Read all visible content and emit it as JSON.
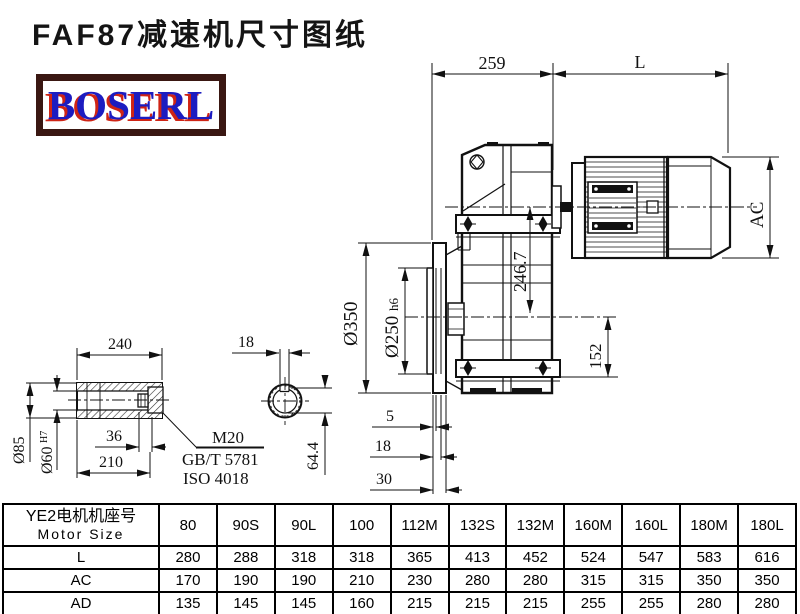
{
  "page": {
    "title": "FAF87减速机尺寸图纸",
    "logo": "BOSERL"
  },
  "drawing": {
    "dim_259": "259",
    "dim_L": "L",
    "dim_AC": "AC",
    "dim_246_7": "246.7",
    "dim_152": "152",
    "dim_d350": "Ø350",
    "dim_d250": "Ø250",
    "dim_d250_tol": "h6",
    "dim_5": "5",
    "dim_18_flange": "18",
    "dim_30": "30",
    "dim_240": "240",
    "dim_36": "36",
    "dim_210": "210",
    "dim_d85": "Ø85",
    "dim_d60": "Ø60",
    "dim_d60_tol": "H7",
    "dim_18_key": "18",
    "dim_64_4": "64.4",
    "note_thread": "M20",
    "note_gb": "GB/T 5781",
    "note_iso": "ISO 4018"
  },
  "table": {
    "header_cn": "YE2电机机座号",
    "header_en": "Motor Size",
    "columns": [
      "80",
      "90S",
      "90L",
      "100",
      "112M",
      "132S",
      "132M",
      "160M",
      "160L",
      "180M",
      "180L"
    ],
    "rows": [
      {
        "label": "L",
        "values": [
          "280",
          "288",
          "318",
          "318",
          "365",
          "413",
          "452",
          "524",
          "547",
          "583",
          "616"
        ]
      },
      {
        "label": "AC",
        "values": [
          "170",
          "190",
          "190",
          "210",
          "230",
          "280",
          "280",
          "315",
          "315",
          "350",
          "350"
        ]
      },
      {
        "label": "AD",
        "values": [
          "135",
          "145",
          "145",
          "160",
          "215",
          "215",
          "215",
          "255",
          "255",
          "280",
          "280"
        ]
      }
    ]
  }
}
